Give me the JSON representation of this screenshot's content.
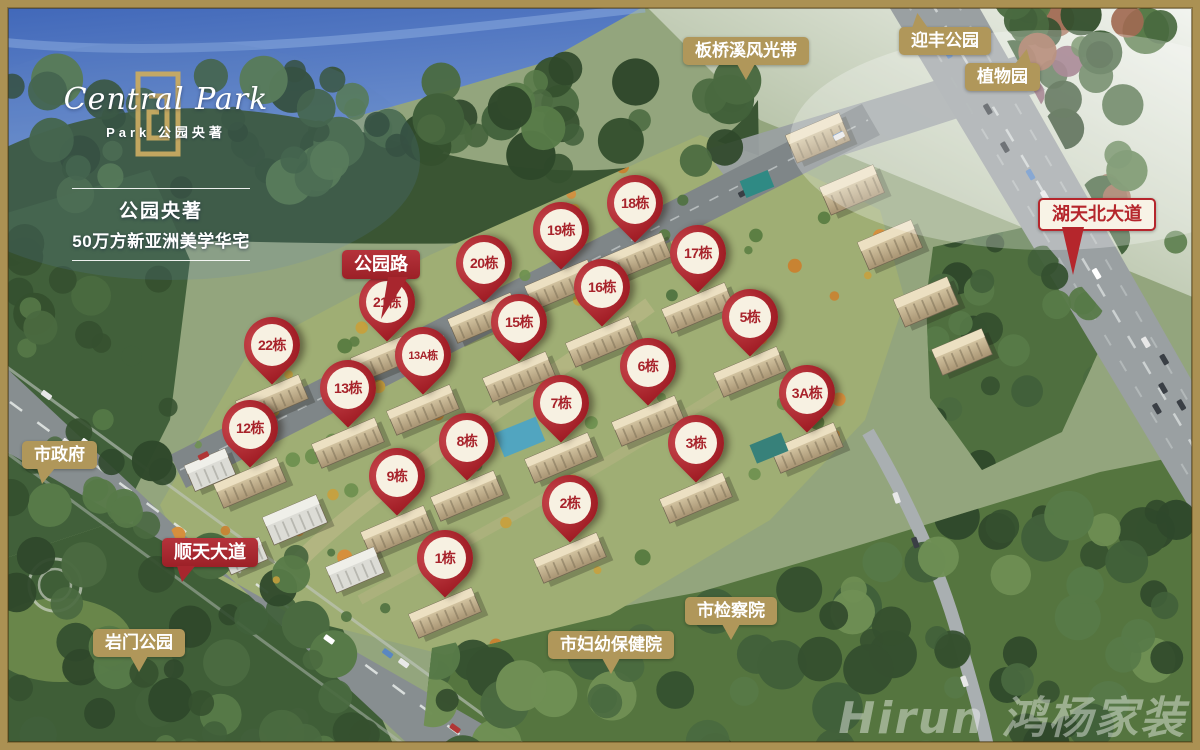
{
  "branding": {
    "logo_script": "Central Park",
    "logo_sub": "Park 公园央著",
    "tagline_line1": "公园央著",
    "tagline_line2": "50万方新亚洲美学华宅"
  },
  "colors": {
    "label_gold": "#b0975a",
    "label_red": "#a8262e",
    "pin_red": "#a42028",
    "pin_text_red": "#a8232b",
    "frame_gold": "#ab9153"
  },
  "location_labels": [
    {
      "text": "板桥溪风光带",
      "style": "gold",
      "pointer": "bottom-center",
      "x": 683,
      "y": 37
    },
    {
      "text": "迎丰公园",
      "style": "gold",
      "pointer": "top-left",
      "x": 899,
      "y": 27
    },
    {
      "text": "植物园",
      "style": "gold",
      "pointer": "top-right",
      "x": 965,
      "y": 63
    },
    {
      "text": "湖天北大道",
      "style": "outline-red",
      "pointer": "bottom-left-long",
      "x": 1038,
      "y": 198
    },
    {
      "text": "公园路",
      "style": "red",
      "pointer": "bottom-right-long",
      "x": 342,
      "y": 250
    },
    {
      "text": "市政府",
      "style": "gold",
      "pointer": "bottom-left",
      "x": 22,
      "y": 441
    },
    {
      "text": "顺天大道",
      "style": "red",
      "pointer": "bottom-left",
      "x": 162,
      "y": 538
    },
    {
      "text": "岩门公园",
      "style": "gold",
      "pointer": "bottom-center",
      "x": 93,
      "y": 629
    },
    {
      "text": "市妇幼保健院",
      "style": "gold",
      "pointer": "bottom-center",
      "x": 548,
      "y": 631
    },
    {
      "text": "市检察院",
      "style": "gold",
      "pointer": "bottom-center",
      "x": 685,
      "y": 597
    }
  ],
  "building_pins": [
    {
      "label": "18栋",
      "x": 635,
      "y": 203
    },
    {
      "label": "19栋",
      "x": 561,
      "y": 230
    },
    {
      "label": "20栋",
      "x": 484,
      "y": 263
    },
    {
      "label": "21栋",
      "x": 387,
      "y": 302
    },
    {
      "label": "22栋",
      "x": 272,
      "y": 345
    },
    {
      "label": "17栋",
      "x": 698,
      "y": 253
    },
    {
      "label": "16栋",
      "x": 602,
      "y": 287
    },
    {
      "label": "15栋",
      "x": 519,
      "y": 322
    },
    {
      "label": "13A栋",
      "x": 423,
      "y": 355
    },
    {
      "label": "13栋",
      "x": 348,
      "y": 388
    },
    {
      "label": "12栋",
      "x": 250,
      "y": 428
    },
    {
      "label": "5栋",
      "x": 750,
      "y": 317
    },
    {
      "label": "6栋",
      "x": 648,
      "y": 366
    },
    {
      "label": "7栋",
      "x": 561,
      "y": 403
    },
    {
      "label": "8栋",
      "x": 467,
      "y": 441
    },
    {
      "label": "9栋",
      "x": 397,
      "y": 476
    },
    {
      "label": "3A栋",
      "x": 807,
      "y": 393
    },
    {
      "label": "3栋",
      "x": 696,
      "y": 443
    },
    {
      "label": "2栋",
      "x": 570,
      "y": 503
    },
    {
      "label": "1栋",
      "x": 445,
      "y": 558
    }
  ],
  "watermark": "Hirun 鸿杨家装"
}
